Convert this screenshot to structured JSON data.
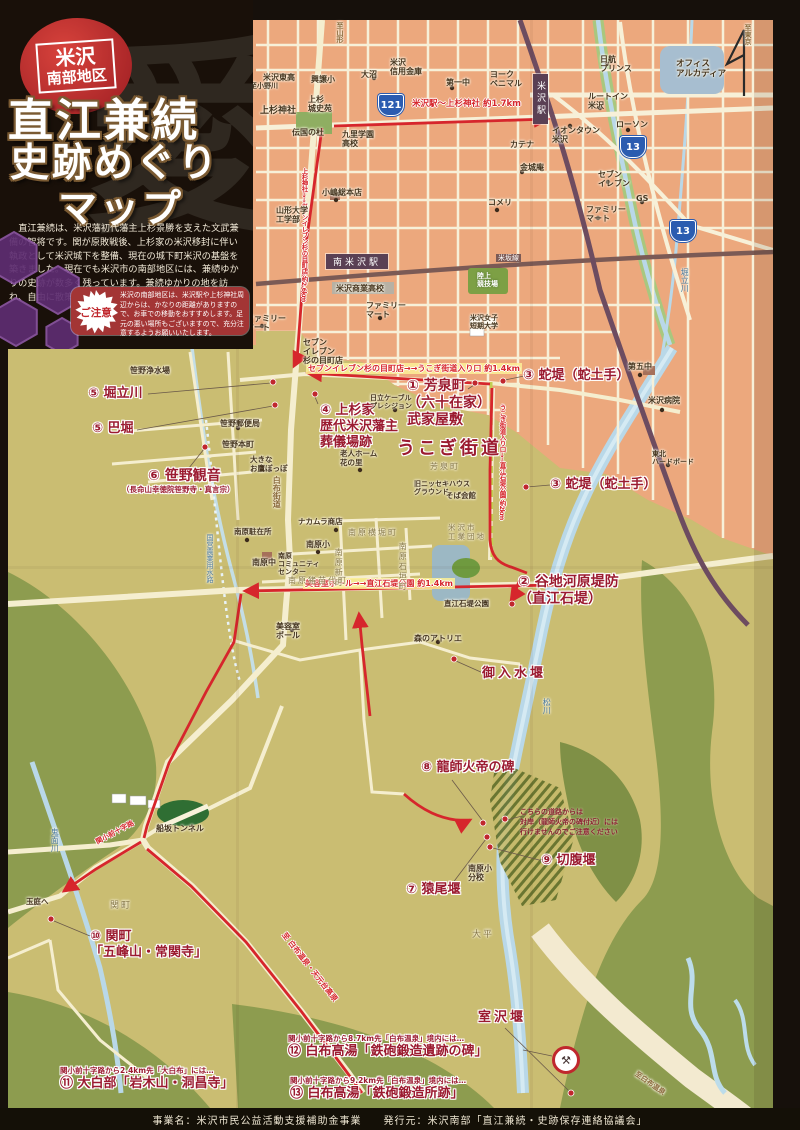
{
  "title_panel": {
    "badge_top": "米沢",
    "badge_bottom": "南部地区",
    "title1": "直江兼続",
    "title2": "史跡めぐり",
    "title3": "マップ",
    "watermark": "愛",
    "description": "直江兼続は、米沢藩初代藩主上杉景勝を支えた文武兼備の智将です。関が原敗戦後、上杉家の米沢移封に伴い執政として米沢城下を整備、現在の城下町米沢の基盤を築きました。現在でも米沢市の南部地区には、兼続ゆかりの史跡が数多く残っています。兼続ゆかりの地を訪ね、自由に散策してみましょう。",
    "notice_label": "ご注意",
    "notice_text": "米沢の南部地区は、米沢駅や上杉神社周辺からは、かなりの距離がありますので、お車での移動をおすすめします。足元の悪い場所もございますので、充分注意するようお願いいたします。"
  },
  "footer": {
    "text": "事業名：米沢市民公益活動支援補助金事業　　発行元：米沢南部「直江兼続・史跡保存連絡協議会」"
  },
  "map": {
    "sites": [
      {
        "t": "① 芳泉町\n（六十在家）\n武家屋敷",
        "x": 407,
        "y": 378,
        "size": 14
      },
      {
        "t": "② 谷地河原堤防\n（直江石堤）",
        "x": 518,
        "y": 574,
        "size": 14
      },
      {
        "t": "③ 蛇堤（蛇土手）",
        "x": 523,
        "y": 368
      },
      {
        "t": "③ 蛇堤（蛇土手）",
        "x": 550,
        "y": 477
      },
      {
        "t": "④ 上杉家\n歴代米沢藩主\n葬儀場跡",
        "x": 320,
        "y": 403
      },
      {
        "t": "⑤ 堀立川",
        "x": 88,
        "y": 386
      },
      {
        "t": "⑤ 巴堀",
        "x": 92,
        "y": 421
      },
      {
        "t": "⑥ 笹野観音",
        "x": 148,
        "y": 468,
        "size": 14,
        "sub": "（長命山幸徳院笹野寺・真言宗）"
      },
      {
        "t": "⑦ 猿尾堰",
        "x": 406,
        "y": 882
      },
      {
        "t": "⑧ 龍師火帝の碑",
        "x": 421,
        "y": 760
      },
      {
        "t": "⑨ 切腹堰",
        "x": 541,
        "y": 853
      },
      {
        "t": "⑩ 関町\n「五峰山・常関寺」",
        "x": 90,
        "y": 929
      },
      {
        "t": "⑪ 大白部「岩木山・洞昌寺」",
        "x": 60,
        "y": 1066,
        "lead": "関小前十字路から2.4km先「大白布」には…"
      },
      {
        "t": "⑫ 白布高湯「鉄砲鍛造遺跡の碑」",
        "x": 288,
        "y": 1034,
        "lead": "関小前十字路から8.7km先「白布温泉」境内には…"
      },
      {
        "t": "⑬ 白布高湯「鉄砲鍛造所跡」",
        "x": 290,
        "y": 1076,
        "lead": "関小前十字路から9.2km先「白布温泉」境内には…"
      },
      {
        "t": "うこぎ街道",
        "x": 397,
        "y": 438,
        "size": 18,
        "cls": "big"
      },
      {
        "t": "御入水堰",
        "x": 482,
        "y": 666,
        "cls": "big"
      },
      {
        "t": "室沢堰",
        "x": 478,
        "y": 1010,
        "cls": "big"
      }
    ],
    "route_labels": [
      {
        "t": "米沢駅～上杉神社 約1.7km",
        "x": 412,
        "y": 97
      },
      {
        "t": "上杉神社→→セブンイレブン杉の目町店 約2.6km",
        "x": 299,
        "y": 168,
        "v": true,
        "size": 6.5
      },
      {
        "t": "セブンイレブン杉の目町店→→うこぎ街道入り口 約1.4km",
        "x": 306,
        "y": 363,
        "cls": "hl",
        "size": 8
      },
      {
        "t": "うこぎ街道入り口→→直江石堤公園 約2km",
        "x": 497,
        "y": 404,
        "v": true,
        "size": 6.5
      },
      {
        "t": "美容室ポール→→直江石堤公園 約1.4km",
        "x": 303,
        "y": 578,
        "cls": "hl",
        "size": 8
      },
      {
        "t": "至 白布温泉・天元台高原",
        "x": 288,
        "y": 930,
        "rot": 52,
        "size": 7.5
      },
      {
        "t": "関小前十字路",
        "x": 94,
        "y": 838,
        "rot": -28,
        "size": 7
      }
    ],
    "labels": [
      {
        "t": "米沢東高",
        "x": 263,
        "y": 73
      },
      {
        "t": "興譲小",
        "x": 311,
        "y": 75
      },
      {
        "t": "大沼",
        "x": 361,
        "y": 70
      },
      {
        "t": "米沢\n信用金庫",
        "x": 390,
        "y": 58
      },
      {
        "t": "ヨーク\nベニマル",
        "x": 490,
        "y": 70
      },
      {
        "t": "第一中",
        "x": 446,
        "y": 78
      },
      {
        "t": "上杉神社",
        "x": 260,
        "y": 106,
        "size": 9
      },
      {
        "t": "上杉\n城史苑",
        "x": 308,
        "y": 95
      },
      {
        "t": "伝国の杜",
        "x": 292,
        "y": 128
      },
      {
        "t": "九里学園\n高校",
        "x": 342,
        "y": 130
      },
      {
        "t": "小嶋総本店",
        "x": 322,
        "y": 188
      },
      {
        "t": "山形大学\n工学部",
        "x": 276,
        "y": 206
      },
      {
        "t": "米沢商業高校",
        "x": 336,
        "y": 284
      },
      {
        "t": "ファミリー\nマート",
        "x": 366,
        "y": 301
      },
      {
        "t": "ファミリー\nマート",
        "x": 246,
        "y": 314
      },
      {
        "t": "セブン\nイレブン\n杉の目町店",
        "x": 303,
        "y": 338
      },
      {
        "t": "陸上\n競技場",
        "x": 477,
        "y": 272,
        "cls": "green",
        "size": 7
      },
      {
        "t": "米沢女子\n短期大学",
        "x": 470,
        "y": 314,
        "size": 7
      },
      {
        "t": "ルートイン\n米沢",
        "x": 588,
        "y": 92
      },
      {
        "t": "イオンタウン\n米沢",
        "x": 552,
        "y": 126
      },
      {
        "t": "ローソン",
        "x": 616,
        "y": 120
      },
      {
        "t": "カテナ",
        "x": 510,
        "y": 140
      },
      {
        "t": "金城庵",
        "x": 520,
        "y": 163
      },
      {
        "t": "コメリ",
        "x": 488,
        "y": 198
      },
      {
        "t": "セブン\nイレブン",
        "x": 598,
        "y": 170
      },
      {
        "t": "ファミリー\nマート",
        "x": 586,
        "y": 205
      },
      {
        "t": "GS",
        "x": 636,
        "y": 194
      },
      {
        "t": "日航\nプリンス",
        "x": 600,
        "y": 55
      },
      {
        "t": "オフィス\nアルカディア",
        "x": 676,
        "y": 60,
        "size": 8.5
      },
      {
        "t": "第五中",
        "x": 628,
        "y": 362
      },
      {
        "t": "米沢病院",
        "x": 648,
        "y": 396
      },
      {
        "t": "東北\nハードボード",
        "x": 652,
        "y": 450,
        "size": 7
      },
      {
        "t": "芳泉町",
        "x": 430,
        "y": 462,
        "cls": "area"
      },
      {
        "t": "旧ニッセキハウス\nグラウンド",
        "x": 414,
        "y": 480,
        "size": 7
      },
      {
        "t": "そば会館",
        "x": 446,
        "y": 492,
        "size": 7.5
      },
      {
        "t": "米沢市\n工業団地",
        "x": 448,
        "y": 524,
        "cls": "area",
        "size": 7.5
      },
      {
        "t": "直江石堤公園",
        "x": 444,
        "y": 600,
        "size": 7.5
      },
      {
        "t": "森のアトリエ",
        "x": 414,
        "y": 634
      },
      {
        "t": "老人ホーム\n花の里",
        "x": 340,
        "y": 450,
        "size": 7.5
      },
      {
        "t": "日立ケーブル\nプレシジョン",
        "x": 370,
        "y": 394,
        "size": 7
      },
      {
        "t": "ナカムラ商店",
        "x": 298,
        "y": 518,
        "size": 7.5
      },
      {
        "t": "南原横堀町",
        "x": 348,
        "y": 528,
        "cls": "area"
      },
      {
        "t": "南原石垣町",
        "x": 398,
        "y": 542,
        "v": true,
        "cls": "area"
      },
      {
        "t": "南原新町",
        "x": 334,
        "y": 548,
        "v": true,
        "cls": "area"
      },
      {
        "t": "南原猪苗代町",
        "x": 288,
        "y": 576,
        "cls": "area"
      },
      {
        "t": "南原小",
        "x": 306,
        "y": 540
      },
      {
        "t": "南原\nコミュニティ\nセンター",
        "x": 278,
        "y": 552,
        "size": 7
      },
      {
        "t": "南原駐在所",
        "x": 234,
        "y": 528,
        "size": 7.5
      },
      {
        "t": "南原中",
        "x": 252,
        "y": 558
      },
      {
        "t": "美容室\nポール",
        "x": 276,
        "y": 622
      },
      {
        "t": "南原小\n分校",
        "x": 468,
        "y": 864
      },
      {
        "t": "笹野浄水場",
        "x": 130,
        "y": 366
      },
      {
        "t": "笹野郵便局",
        "x": 220,
        "y": 419
      },
      {
        "t": "笹野本町",
        "x": 222,
        "y": 440
      },
      {
        "t": "大きな\nお鷹ぽっぽ",
        "x": 250,
        "y": 456,
        "size": 7.5
      },
      {
        "t": "関町",
        "x": 110,
        "y": 901,
        "cls": "area",
        "size": 9
      },
      {
        "t": "大平",
        "x": 472,
        "y": 930,
        "cls": "area",
        "size": 9
      },
      {
        "t": "船坂トンネル",
        "x": 156,
        "y": 824
      },
      {
        "t": "玉庭へ",
        "x": 26,
        "y": 898,
        "size": 7.5
      },
      {
        "t": "米坂線",
        "x": 496,
        "y": 254,
        "cls": "rail"
      },
      {
        "t": "至小野川",
        "x": 250,
        "y": 82,
        "size": 7
      },
      {
        "t": "白布街道",
        "x": 272,
        "y": 476,
        "v": true,
        "cls": "road"
      },
      {
        "t": "堀立川",
        "x": 680,
        "y": 268,
        "v": true,
        "cls": "water"
      },
      {
        "t": "鬼面川",
        "x": 50,
        "y": 828,
        "v": true,
        "cls": "water"
      },
      {
        "t": "松川",
        "x": 542,
        "y": 698,
        "v": true,
        "cls": "water"
      },
      {
        "t": "至白布温泉",
        "x": 638,
        "y": 1070,
        "rot": 35,
        "cls": "road",
        "size": 7
      },
      {
        "t": "国営農業用水路",
        "x": 206,
        "y": 534,
        "v": true,
        "cls": "water",
        "size": 7
      },
      {
        "t": "至東京",
        "x": 744,
        "y": 24,
        "v": true,
        "cls": "road",
        "size": 7
      },
      {
        "t": "至山形",
        "x": 336,
        "y": 22,
        "v": true,
        "cls": "road",
        "size": 7
      }
    ],
    "stations": [
      {
        "t": "米沢駅",
        "x": 533,
        "y": 74,
        "v": true
      },
      {
        "t": "南米沢駅",
        "x": 326,
        "y": 254
      }
    ],
    "badges": [
      {
        "n": "121",
        "x": 378,
        "y": 94
      },
      {
        "n": "13",
        "x": 620,
        "y": 136
      },
      {
        "n": "13",
        "x": 670,
        "y": 220
      }
    ],
    "notes": [
      {
        "t": "こちらの道路からは\n対岸（龍師火帝の碑付近）には\n行けませんのでご注意ください",
        "x": 520,
        "y": 808
      }
    ],
    "icons": {
      "crossed_hammers": "⚒",
      "north_arrow": "N"
    },
    "colors": {
      "accent_red": "#d6262c",
      "site_text": "#9b1b30",
      "urban": "#eca87d",
      "rural": "#cabd72",
      "hills": "#8d9c4f",
      "river": "#b9d8e8",
      "railway": "#6d4c60",
      "frame": "#16100b",
      "badge_blue": "#2b5cb0",
      "notice_bg": "#a33535",
      "title_badge": "#c0272d"
    }
  }
}
